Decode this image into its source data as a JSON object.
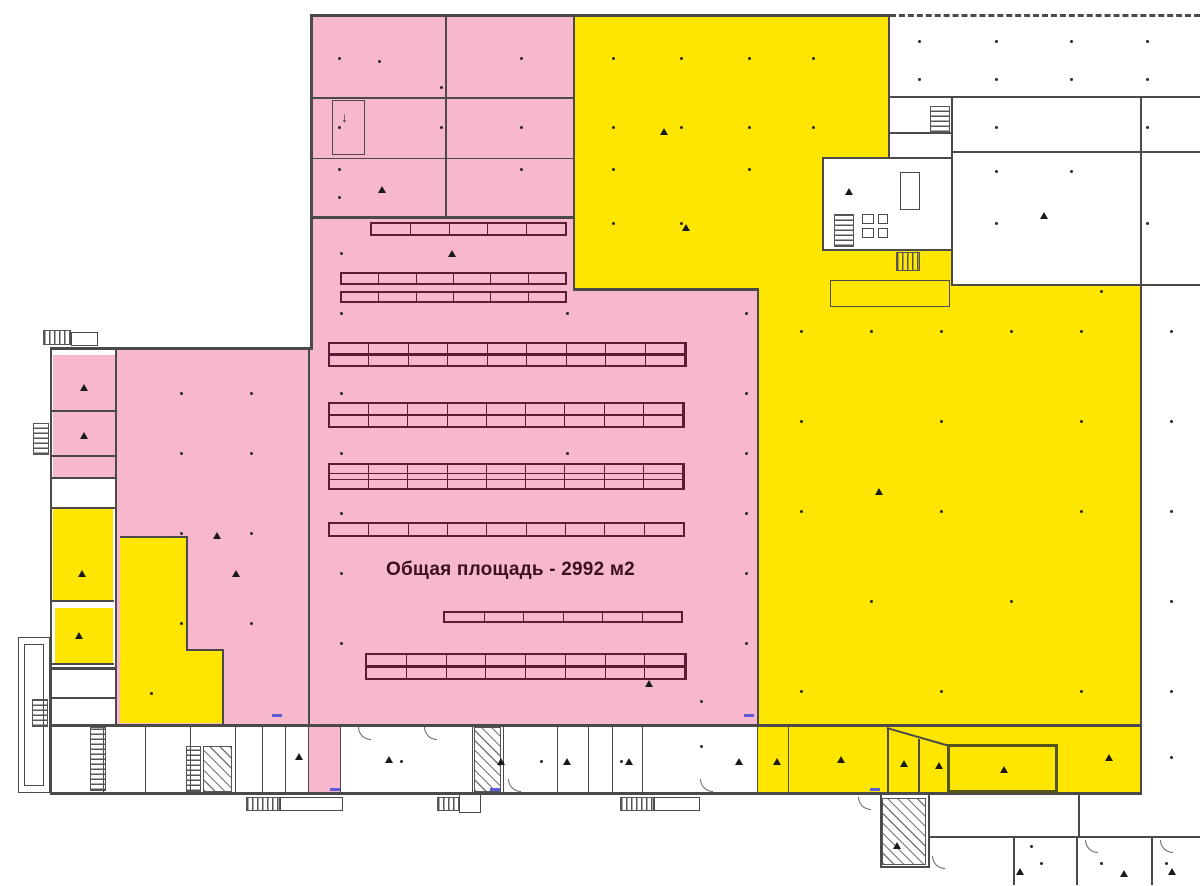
{
  "labels": {
    "area_text": "Общая площадь -  2992 м2"
  },
  "colors": {
    "pink": "#F7B7CC",
    "yellow": "#FFE600",
    "wall": "#4A4A4A",
    "rack": "#5C1C38",
    "label_text": "#3A1120",
    "dim": "#5C5CD6"
  },
  "plan": {
    "zones": {
      "pink": [
        {
          "n": "zone-pink-main-hall-upper",
          "r": [
            310,
            15,
            263,
            710
          ]
        },
        {
          "n": "zone-pink-main-hall-east",
          "r": [
            573,
            290,
            184,
            435
          ]
        },
        {
          "n": "zone-pink-west-annex",
          "r": [
            117,
            348,
            193,
            377
          ]
        },
        {
          "n": "zone-pink-west-rooms",
          "r": [
            53,
            355,
            62,
            122
          ]
        },
        {
          "n": "zone-pink-strip-room",
          "r": [
            308,
            726,
            32,
            67
          ]
        }
      ],
      "yellow": [
        {
          "n": "zone-yellow-north-block",
          "r": [
            573,
            15,
            317,
            143
          ]
        },
        {
          "n": "zone-yellow-north-block-lower",
          "r": [
            573,
            158,
            249,
            132
          ]
        },
        {
          "n": "zone-yellow-east-hall",
          "r": [
            757,
            250,
            383,
            545
          ]
        },
        {
          "n": "zone-yellow-west-room-a",
          "r": [
            53,
            508,
            60,
            92
          ]
        },
        {
          "n": "zone-yellow-west-room-b",
          "r": [
            55,
            608,
            58,
            55
          ]
        },
        {
          "n": "zone-yellow-l-room-vertical",
          "r": [
            120,
            537,
            66,
            186
          ]
        },
        {
          "n": "zone-yellow-l-room-step",
          "r": [
            186,
            650,
            36,
            73
          ]
        },
        {
          "n": "zone-yellow-strip-room-1",
          "r": [
            887,
            730,
            31,
            63
          ]
        },
        {
          "n": "zone-yellow-strip-room-2",
          "r": [
            918,
            739,
            29,
            54
          ]
        },
        {
          "n": "zone-yellow-strip-room-3",
          "r": [
            947,
            744,
            111,
            49
          ]
        }
      ],
      "white": [
        {
          "n": "zone-white-tech-cluster",
          "r": [
            822,
            158,
            129,
            92
          ]
        },
        {
          "n": "zone-white-big-room",
          "r": [
            951,
            152,
            191,
            133
          ]
        }
      ]
    },
    "walls": [
      [
        310,
        14,
        578,
        3
      ],
      [
        50,
        347,
        262,
        2.5
      ],
      [
        890,
        96,
        310,
        2
      ],
      [
        951,
        151,
        249,
        2
      ],
      [
        951,
        284,
        249,
        2
      ],
      [
        890,
        132,
        62,
        1.5
      ],
      [
        822,
        157,
        129,
        1.5
      ],
      [
        822,
        249,
        129,
        1.5
      ],
      [
        573,
        288,
        186,
        3
      ],
      [
        310,
        216,
        263,
        3
      ],
      [
        310,
        97,
        263,
        2
      ],
      [
        310,
        158,
        263,
        1
      ],
      [
        50,
        724,
        1092,
        2.5
      ],
      [
        50,
        792,
        1092,
        2.5
      ],
      [
        50,
        410,
        65,
        1.5
      ],
      [
        50,
        455,
        65,
        1.5
      ],
      [
        50,
        477,
        65,
        1.5
      ],
      [
        50,
        507,
        65,
        1.5
      ],
      [
        50,
        600,
        64,
        1.5
      ],
      [
        50,
        663,
        64,
        1.5
      ],
      [
        50,
        667,
        65,
        2.5
      ],
      [
        50,
        697,
        65,
        1.5
      ],
      [
        120,
        536,
        67,
        1.5
      ],
      [
        186,
        649,
        38,
        1.5
      ],
      [
        880,
        866,
        50,
        2
      ],
      [
        928,
        836,
        272,
        2
      ],
      [
        310,
        14,
        2.5,
        336
      ],
      [
        50,
        347,
        2,
        447
      ],
      [
        888,
        14,
        2,
        145
      ],
      [
        1140,
        96,
        2,
        699
      ],
      [
        951,
        96,
        2,
        190
      ],
      [
        822,
        158,
        1.5,
        92
      ],
      [
        757,
        288,
        2,
        438
      ],
      [
        573,
        14,
        2,
        276
      ],
      [
        445,
        14,
        2,
        203
      ],
      [
        308,
        348,
        2,
        378
      ],
      [
        115,
        348,
        1.5,
        377
      ],
      [
        186,
        536,
        1.5,
        114
      ],
      [
        222,
        649,
        1.5,
        77
      ],
      [
        103,
        726,
        1.2,
        67
      ],
      [
        145,
        726,
        1.2,
        67
      ],
      [
        190,
        726,
        1.2,
        67
      ],
      [
        235,
        726,
        1.2,
        67
      ],
      [
        262,
        726,
        1.2,
        67
      ],
      [
        285,
        726,
        1.2,
        67
      ],
      [
        308,
        726,
        1.2,
        67
      ],
      [
        340,
        726,
        1.2,
        67
      ],
      [
        472,
        726,
        1.2,
        67
      ],
      [
        503,
        726,
        1.2,
        67
      ],
      [
        557,
        726,
        1.2,
        67
      ],
      [
        588,
        726,
        1.2,
        67
      ],
      [
        612,
        726,
        1.2,
        67
      ],
      [
        642,
        726,
        1.2,
        67
      ],
      [
        757,
        726,
        1.2,
        67
      ],
      [
        788,
        726,
        1.2,
        67
      ],
      [
        887,
        729,
        1.5,
        64
      ],
      [
        918,
        739,
        1.5,
        54
      ],
      [
        880,
        794,
        2,
        74
      ],
      [
        928,
        794,
        2,
        74
      ],
      [
        1078,
        794,
        1.5,
        43
      ],
      [
        1013,
        837,
        1.5,
        48
      ],
      [
        1076,
        837,
        1.5,
        48
      ],
      [
        1151,
        837,
        1.5,
        48
      ]
    ],
    "dashed_walls": [
      [
        890,
        14,
        310,
        0
      ]
    ],
    "diagonal_walls": [
      [
        887,
        727,
        64,
        2,
        16
      ]
    ],
    "racks": [
      {
        "r": [
          370,
          222,
          197,
          14
        ],
        "seg": 5,
        "mid": 0
      },
      {
        "r": [
          340,
          272,
          227,
          13
        ],
        "seg": 6,
        "mid": 0
      },
      {
        "r": [
          340,
          291,
          227,
          12
        ],
        "seg": 6,
        "mid": 0
      },
      {
        "r": [
          328,
          342,
          359,
          25
        ],
        "seg": 9,
        "mid": 1
      },
      {
        "r": [
          328,
          402,
          357,
          26
        ],
        "seg": 9,
        "mid": 1
      },
      {
        "r": [
          328,
          463,
          357,
          27
        ],
        "seg": 9,
        "mid": 2
      },
      {
        "r": [
          328,
          522,
          357,
          15
        ],
        "seg": 9,
        "mid": 0
      },
      {
        "r": [
          443,
          611,
          240,
          12
        ],
        "seg": 6,
        "mid": 0
      },
      {
        "r": [
          365,
          653,
          322,
          27
        ],
        "seg": 8,
        "mid": 1
      }
    ],
    "stairs": {
      "h": [
        [
          43,
          330,
          28,
          15
        ],
        [
          246,
          797,
          34,
          14
        ],
        [
          437,
          797,
          22,
          14
        ],
        [
          620,
          797,
          34,
          14
        ],
        [
          896,
          252,
          24,
          19
        ]
      ],
      "v": [
        [
          33,
          423,
          16,
          32
        ],
        [
          32,
          699,
          16,
          28
        ],
        [
          90,
          727,
          16,
          64
        ],
        [
          186,
          746,
          15,
          46
        ],
        [
          930,
          106,
          20,
          27
        ],
        [
          834,
          214,
          20,
          33
        ]
      ],
      "d": [
        [
          203,
          746,
          29,
          46
        ],
        [
          474,
          727,
          27,
          65
        ],
        [
          882,
          798,
          44,
          67
        ]
      ]
    },
    "outlines": {
      "thin": [
        [
          332,
          100,
          33,
          55
        ],
        [
          830,
          280,
          120,
          27
        ],
        [
          280,
          797,
          63,
          14
        ],
        [
          654,
          797,
          46,
          14
        ],
        [
          459,
          794,
          22,
          19
        ],
        [
          71,
          332,
          27,
          14
        ],
        [
          18,
          637,
          32,
          156
        ],
        [
          24,
          644,
          20,
          142
        ],
        [
          900,
          172,
          20,
          38
        ],
        [
          862,
          214,
          12,
          10
        ],
        [
          862,
          228,
          12,
          10
        ],
        [
          878,
          214,
          10,
          10
        ],
        [
          878,
          228,
          10,
          10
        ]
      ],
      "thick": [
        [
          947,
          744,
          111,
          49
        ]
      ]
    },
    "doors": [
      [
        358,
        727
      ],
      [
        424,
        727
      ],
      [
        508,
        779
      ],
      [
        700,
        779
      ],
      [
        858,
        797
      ],
      [
        932,
        856
      ],
      [
        1085,
        840
      ],
      [
        1160,
        840
      ]
    ],
    "dots": [
      [
        338,
        57
      ],
      [
        378,
        60
      ],
      [
        440,
        86
      ],
      [
        520,
        57
      ],
      [
        338,
        126
      ],
      [
        440,
        126
      ],
      [
        520,
        126
      ],
      [
        338,
        168
      ],
      [
        520,
        168
      ],
      [
        338,
        196
      ],
      [
        612,
        57
      ],
      [
        680,
        57
      ],
      [
        748,
        57
      ],
      [
        812,
        57
      ],
      [
        612,
        126
      ],
      [
        680,
        126
      ],
      [
        748,
        126
      ],
      [
        812,
        126
      ],
      [
        612,
        168
      ],
      [
        748,
        168
      ],
      [
        612,
        222
      ],
      [
        680,
        222
      ],
      [
        918,
        40
      ],
      [
        995,
        40
      ],
      [
        1070,
        40
      ],
      [
        1146,
        40
      ],
      [
        918,
        78
      ],
      [
        995,
        78
      ],
      [
        1070,
        78
      ],
      [
        1146,
        78
      ],
      [
        995,
        126
      ],
      [
        1146,
        126
      ],
      [
        995,
        170
      ],
      [
        1070,
        170
      ],
      [
        995,
        222
      ],
      [
        1146,
        222
      ],
      [
        340,
        252
      ],
      [
        340,
        312
      ],
      [
        566,
        312
      ],
      [
        340,
        392
      ],
      [
        340,
        452
      ],
      [
        566,
        452
      ],
      [
        340,
        512
      ],
      [
        340,
        572
      ],
      [
        340,
        642
      ],
      [
        745,
        312
      ],
      [
        745,
        392
      ],
      [
        745,
        452
      ],
      [
        745,
        512
      ],
      [
        745,
        572
      ],
      [
        745,
        642
      ],
      [
        700,
        700
      ],
      [
        800,
        330
      ],
      [
        870,
        330
      ],
      [
        940,
        330
      ],
      [
        1010,
        330
      ],
      [
        1080,
        330
      ],
      [
        800,
        420
      ],
      [
        940,
        420
      ],
      [
        1080,
        420
      ],
      [
        800,
        510
      ],
      [
        940,
        510
      ],
      [
        1080,
        510
      ],
      [
        870,
        600
      ],
      [
        1010,
        600
      ],
      [
        800,
        690
      ],
      [
        940,
        690
      ],
      [
        1080,
        690
      ],
      [
        1100,
        290
      ],
      [
        180,
        392
      ],
      [
        250,
        392
      ],
      [
        180,
        452
      ],
      [
        250,
        452
      ],
      [
        180,
        532
      ],
      [
        250,
        532
      ],
      [
        180,
        622
      ],
      [
        250,
        622
      ],
      [
        150,
        692
      ],
      [
        1170,
        330
      ],
      [
        1170,
        420
      ],
      [
        1170,
        510
      ],
      [
        1170,
        600
      ],
      [
        1170,
        690
      ],
      [
        1170,
        756
      ],
      [
        400,
        760
      ],
      [
        540,
        760
      ],
      [
        620,
        760
      ],
      [
        700,
        745
      ],
      [
        1040,
        862
      ],
      [
        1100,
        862
      ],
      [
        1165,
        862
      ],
      [
        1030,
        845
      ]
    ],
    "triangles": [
      [
        378,
        186
      ],
      [
        232,
        570
      ],
      [
        660,
        128
      ],
      [
        682,
        224
      ],
      [
        845,
        188
      ],
      [
        1040,
        212
      ],
      [
        875,
        488
      ],
      [
        213,
        532
      ],
      [
        645,
        680
      ],
      [
        80,
        384
      ],
      [
        80,
        432
      ],
      [
        78,
        570
      ],
      [
        75,
        632
      ],
      [
        295,
        753
      ],
      [
        385,
        756
      ],
      [
        497,
        758
      ],
      [
        563,
        758
      ],
      [
        625,
        758
      ],
      [
        735,
        758
      ],
      [
        773,
        758
      ],
      [
        837,
        756
      ],
      [
        900,
        760
      ],
      [
        935,
        762
      ],
      [
        1000,
        766
      ],
      [
        1105,
        754
      ],
      [
        893,
        842
      ],
      [
        1016,
        868
      ],
      [
        1120,
        870
      ],
      [
        1168,
        868
      ],
      [
        448,
        250
      ]
    ],
    "dims": [
      [
        272,
        714
      ],
      [
        744,
        714
      ],
      [
        870,
        788
      ],
      [
        490,
        788
      ],
      [
        330,
        788
      ]
    ],
    "glyphs": [
      {
        "t": "↓",
        "x": 341,
        "y": 110
      }
    ]
  }
}
